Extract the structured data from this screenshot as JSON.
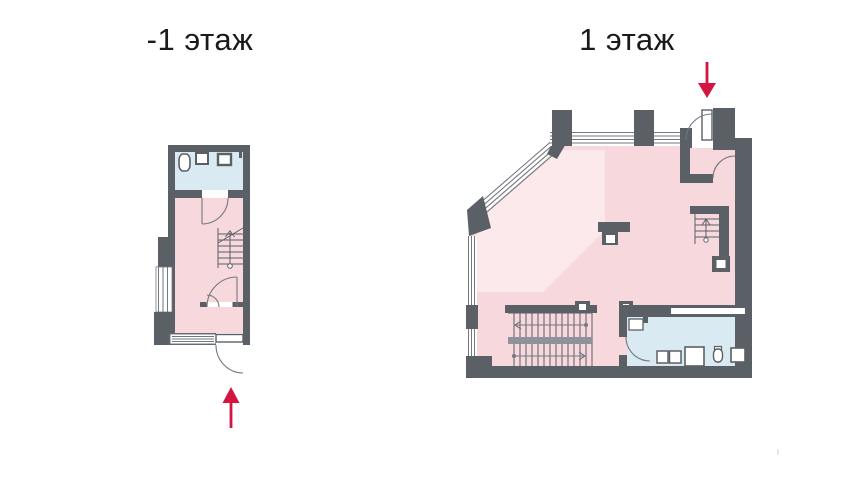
{
  "titles": {
    "left": "-1 этаж",
    "right": "1 этаж"
  },
  "icons": {
    "left_entrance_arrow": "up-arrow",
    "right_entrance_arrow": "down-arrow"
  },
  "colors": {
    "page_bg": "#ffffff",
    "wall": "#5b6066",
    "room_pink": "#f6d8dd",
    "room_pink_light": "#fbe9ec",
    "bathroom_blue": "#d9eaf3",
    "arrow_red": "#d31540",
    "line": "#73787e",
    "stair_mid": "#8f9399",
    "text": "#1a1a1a"
  }
}
